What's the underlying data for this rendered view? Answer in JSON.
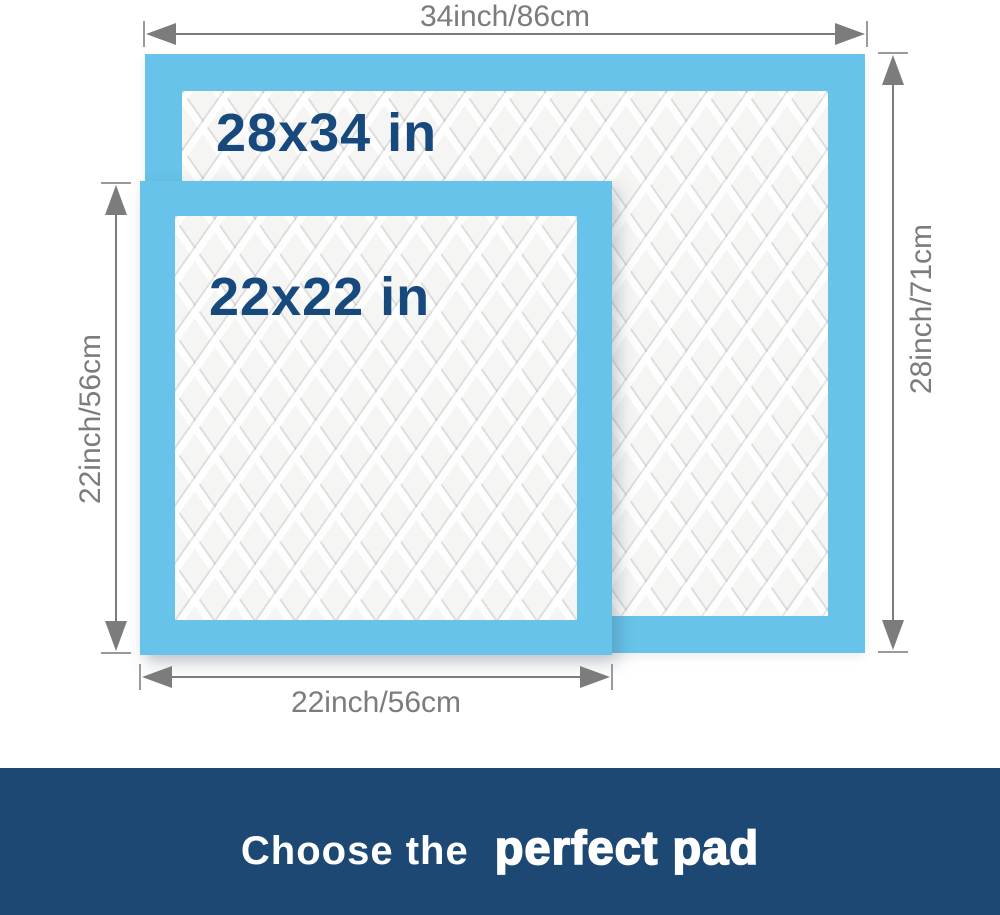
{
  "diagram": {
    "large_pad": {
      "size_label": "28x34 in",
      "width_dimension": "34inch/86cm",
      "height_dimension": "28inch/71cm"
    },
    "small_pad": {
      "size_label": "22x22 in",
      "width_dimension": "22inch/56cm",
      "height_dimension": "22inch/56cm"
    }
  },
  "banner": {
    "prefix": "Choose the",
    "highlight": "perfect pad"
  },
  "colors": {
    "pad-border-blue": "#67c3e9",
    "pad-surface": "#f5f5f4",
    "size-text-navy": "#17497d",
    "dimension-gray": "#7c7c7c",
    "banner-navy": "#1d4873",
    "banner-text": "#ffffff",
    "background": "#ffffff"
  }
}
